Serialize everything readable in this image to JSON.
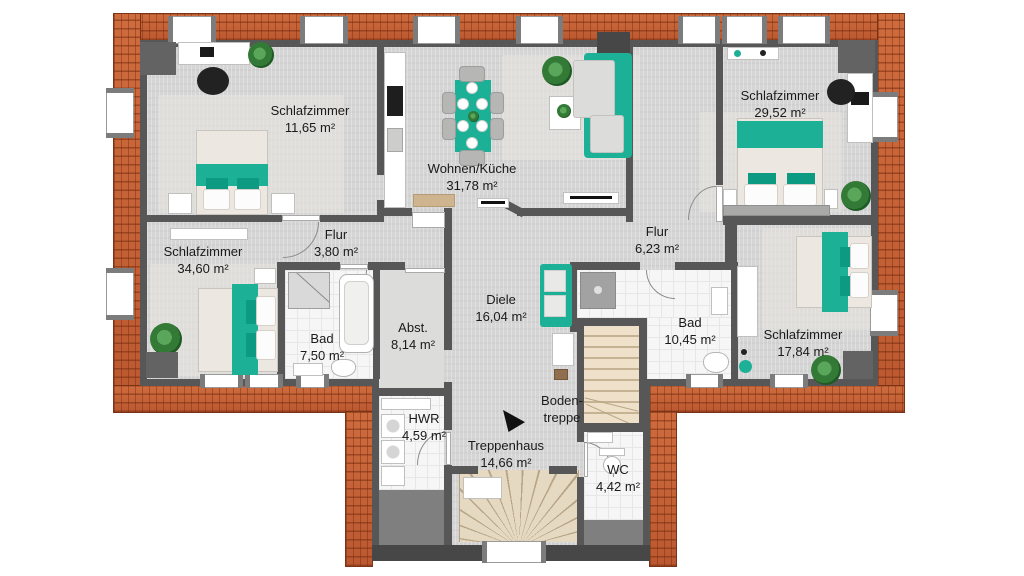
{
  "colors": {
    "accent": "#1cb097",
    "accent_dark": "#0d9a82",
    "roof": "#bb5830",
    "roof_line": "#7c3315",
    "wall": "#575757",
    "wall_dark": "#474747",
    "floor": "#d5d5d5",
    "tile": "#f6f6f6",
    "carpet": "#e7e5df",
    "stairs": "#e6d9c2",
    "text": "#1a1a1a"
  },
  "unit_suffix": "m²",
  "rooms": [
    {
      "id": "schlafzimmer-oben-links",
      "name": "Schlafzimmer",
      "area": "11,65 m²"
    },
    {
      "id": "wohnen-kueche",
      "name": "Wohnen/Küche",
      "area": "31,78 m²"
    },
    {
      "id": "schlafzimmer-oben-rechts",
      "name": "Schlafzimmer",
      "area": "29,52 m²"
    },
    {
      "id": "flur-links",
      "name": "Flur",
      "area": "3,80 m²"
    },
    {
      "id": "schlafzimmer-links",
      "name": "Schlafzimmer",
      "area": "34,60 m²"
    },
    {
      "id": "bad-links",
      "name": "Bad",
      "area": "7,50 m²"
    },
    {
      "id": "abstellraum",
      "name": "Abst.",
      "area": "8,14 m²"
    },
    {
      "id": "diele",
      "name": "Diele",
      "area": "16,04 m²"
    },
    {
      "id": "flur-rechts",
      "name": "Flur",
      "area": "6,23 m²"
    },
    {
      "id": "bad-rechts",
      "name": "Bad",
      "area": "10,45 m²"
    },
    {
      "id": "schlafzimmer-rechts",
      "name": "Schlafzimmer",
      "area": "17,84 m²"
    },
    {
      "id": "hwr",
      "name": "HWR",
      "area": "4,59 m²"
    },
    {
      "id": "treppenhaus",
      "name": "Treppenhaus",
      "area": "14,66 m²"
    },
    {
      "id": "bodentreppe",
      "name": "Boden-",
      "name2": "treppe",
      "area": ""
    },
    {
      "id": "wc",
      "name": "WC",
      "area": "4,42 m²"
    }
  ]
}
